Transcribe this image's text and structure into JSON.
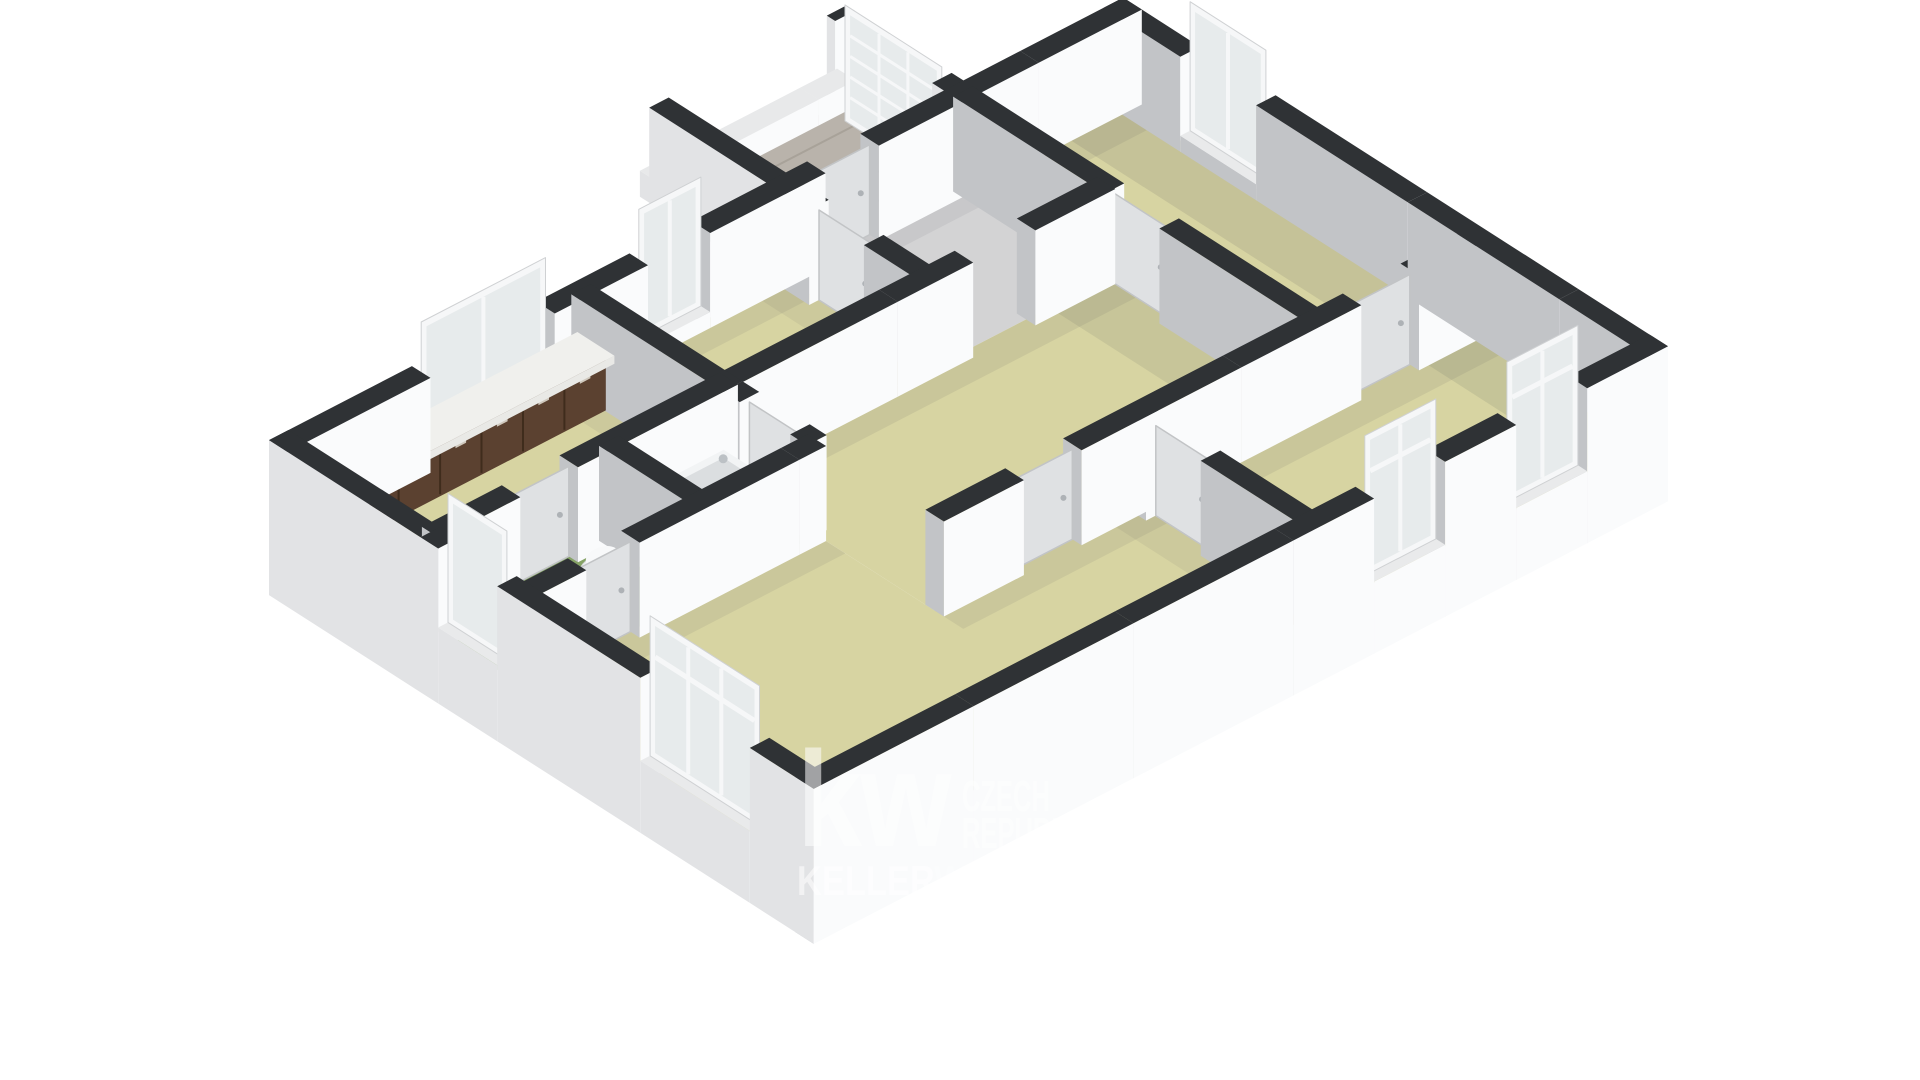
{
  "watermark": {
    "logo": "kw",
    "region_line1": "CZECH",
    "region_line2": "REPUBLIC",
    "brand_bold": "KELLER",
    "brand_light": "WILLIAMS"
  },
  "palette": {
    "bg": "#ffffff",
    "floor_beige": "#d7d4a2",
    "floor_grey": "#d3d3d4",
    "floor_green": "#9cba7f",
    "floor_green_dark": "#8aaa66",
    "tile": "#b9b3ab",
    "tile_line": "#a8a299",
    "wall_top": "#2f3235",
    "wall_face_light": "#fafbfc",
    "wall_face_shade": "#c2c4c7",
    "wall_face_ext": "#e2e3e5",
    "sill_top": "#e9eaeb",
    "frame": "#f6f7f8",
    "frame_edge": "#cfd1d3",
    "glass": "#e7ebec",
    "door_fill": "#dfe1e3",
    "door_stroke": "#c2c4c6",
    "cabinet_front": "#5b4130",
    "cabinet_side": "#49321f",
    "cabinet_line": "#3f2c1c",
    "counter": "#f0f0ed",
    "handle": "#cfc8bd",
    "tub": "#f2f4f5",
    "tub_inner": "#dbdee0",
    "fixture_white": "#eef0f1",
    "shadow_color": "#4a5056"
  },
  "scene": {
    "projection": {
      "origin": [
        288,
        441
      ],
      "u": [
        0.888,
        -0.46
      ],
      "v": [
        0.842,
        0.539
      ],
      "wall_height": 95,
      "slab_depth": 60,
      "wall_thickness": 22
    },
    "landing": {
      "x0": 560,
      "y0": -150,
      "x1": 760,
      "y1": 0,
      "seams": [
        -30,
        -60,
        -90,
        -120
      ]
    },
    "floors": [
      {
        "name": "kitchen",
        "rect": [
          0,
          0,
          330,
          170
        ],
        "color": "floor_beige"
      },
      {
        "name": "bedroom-a",
        "rect": [
          330,
          0,
          230,
          170
        ],
        "color": "floor_beige"
      },
      {
        "name": "entry-hall",
        "rect": [
          560,
          0,
          200,
          170
        ],
        "color": "floor_grey"
      },
      {
        "name": "bedroom-tr",
        "rect": [
          760,
          0,
          180,
          420
        ],
        "color": "floor_beige"
      },
      {
        "name": "bathroom",
        "rect": [
          200,
          170,
          130,
          110
        ],
        "color": "floor_green"
      },
      {
        "name": "wc",
        "rect": [
          0,
          170,
          200,
          110
        ],
        "color": "floor_green_dark"
      },
      {
        "name": "central-room",
        "rect": [
          330,
          170,
          430,
          250
        ],
        "color": "floor_beige"
      },
      {
        "name": "living-room",
        "poly": [
          [
            0,
            280
          ],
          [
            330,
            280
          ],
          [
            330,
            420
          ],
          [
            560,
            420
          ],
          [
            560,
            625
          ],
          [
            0,
            625
          ]
        ],
        "color": "floor_beige"
      },
      {
        "name": "bedroom-br",
        "rect": [
          560,
          420,
          380,
          205
        ],
        "color": "floor_beige"
      }
    ],
    "shadows": [
      [
        294,
        0,
        36,
        170,
        0.08
      ],
      [
        330,
        0,
        230,
        34,
        0.09
      ],
      [
        524,
        0,
        36,
        170,
        0.08
      ],
      [
        560,
        0,
        200,
        30,
        0.08
      ],
      [
        760,
        0,
        180,
        40,
        0.1
      ],
      [
        872,
        0,
        68,
        420,
        0.13
      ],
      [
        330,
        170,
        430,
        36,
        0.1
      ],
      [
        696,
        170,
        64,
        250,
        0.11
      ],
      [
        200,
        170,
        130,
        26,
        0.08
      ],
      [
        0,
        170,
        200,
        26,
        0.08
      ],
      [
        0,
        280,
        330,
        34,
        0.09
      ],
      [
        330,
        420,
        230,
        34,
        0.09
      ],
      [
        524,
        420,
        36,
        205,
        0.08
      ],
      [
        560,
        420,
        380,
        38,
        0.1
      ],
      [
        876,
        420,
        64,
        205,
        0.12
      ]
    ],
    "walls": [
      {
        "name": "ext-nw",
        "o": "x",
        "c": 0,
        "a": -11,
        "b": 951,
        "openings": [
          {
            "a": 150,
            "b": 290,
            "kind": "window",
            "panes": 2
          },
          {
            "a": 395,
            "b": 465,
            "kind": "window",
            "panes": 2
          },
          {
            "a": 595,
            "b": 655,
            "kind": "door"
          }
        ]
      },
      {
        "name": "ext-ne",
        "o": "y",
        "c": 940,
        "a": -11,
        "b": 636,
        "openings": [
          {
            "a": 80,
            "b": 170,
            "kind": "window",
            "panes": 2
          }
        ]
      },
      {
        "name": "ext-se",
        "o": "x",
        "c": 625,
        "a": -11,
        "b": 951,
        "slab": true,
        "openings": [
          {
            "a": 620,
            "b": 700,
            "kind": "window_tall",
            "panes": 2
          },
          {
            "a": 780,
            "b": 860,
            "kind": "window_tall",
            "panes": 2
          }
        ]
      },
      {
        "name": "ext-sw",
        "o": "y",
        "c": 0,
        "a": -11,
        "b": 636,
        "slab": true,
        "west": "light",
        "openings": [
          {
            "a": 190,
            "b": 260,
            "kind": "window",
            "panes": 1
          },
          {
            "a": 430,
            "b": 560,
            "kind": "window_tall",
            "panes": 3
          }
        ]
      },
      {
        "name": "int-kitchen-a",
        "o": "y",
        "c": 330,
        "a": 0,
        "b": 280,
        "openings": [
          {
            "a": 200,
            "b": 260,
            "kind": "door"
          }
        ]
      },
      {
        "name": "int-a-hall",
        "o": "y",
        "c": 560,
        "a": 0,
        "b": 170,
        "openings": [
          {
            "a": 40,
            "b": 105,
            "kind": "door"
          }
        ]
      },
      {
        "name": "int-hall-tr",
        "o": "y",
        "c": 760,
        "a": 0,
        "b": 420,
        "openings": [
          {
            "a": 180,
            "b": 245,
            "kind": "door"
          }
        ]
      },
      {
        "name": "int-top-band",
        "o": "x",
        "c": 170,
        "a": 0,
        "b": 760,
        "openings": [
          {
            "a": 90,
            "b": 155,
            "kind": "door"
          },
          {
            "a": 600,
            "b": 670,
            "kind": "open"
          }
        ]
      },
      {
        "name": "int-wc-bath",
        "o": "y",
        "c": 200,
        "a": 170,
        "b": 280
      },
      {
        "name": "int-wc-south",
        "o": "x",
        "c": 280,
        "a": 0,
        "b": 330,
        "openings": [
          {
            "a": 60,
            "b": 120,
            "kind": "door"
          }
        ]
      },
      {
        "name": "int-mid-south",
        "o": "x",
        "c": 420,
        "a": 330,
        "b": 940,
        "openings": [
          {
            "a": 420,
            "b": 485,
            "kind": "door"
          },
          {
            "a": 800,
            "b": 865,
            "kind": "door"
          }
        ]
      },
      {
        "name": "int-living-br",
        "o": "y",
        "c": 560,
        "a": 420,
        "b": 625,
        "openings": [
          {
            "a": 440,
            "b": 505,
            "kind": "door"
          }
        ]
      },
      {
        "name": "landing-left",
        "o": "y",
        "c": 560,
        "a": -150,
        "b": 0,
        "west": "light"
      },
      {
        "name": "landing-right",
        "o": "y",
        "c": 760,
        "a": -150,
        "b": 0,
        "west": "light",
        "openings": [
          {
            "a": -140,
            "b": -25,
            "kind": "window_paned"
          }
        ]
      },
      {
        "name": "landing-step",
        "o": "x",
        "c": -150,
        "a": 549,
        "b": 771,
        "low": 26,
        "west": "light"
      }
    ],
    "fixtures": {
      "kitchen_cabinets": {
        "x": 40,
        "y": 6,
        "w": 280,
        "d": 34,
        "h": 50,
        "doors": 6
      },
      "bathtub": {
        "x": 230,
        "y": 180,
        "w": 90,
        "d": 70,
        "h": 36
      },
      "washbasin": {
        "x": 214,
        "y": 182,
        "w": 28,
        "d": 26,
        "h": 42
      },
      "toilet": {
        "cx": 150,
        "cy": 215,
        "r": 20
      }
    }
  }
}
